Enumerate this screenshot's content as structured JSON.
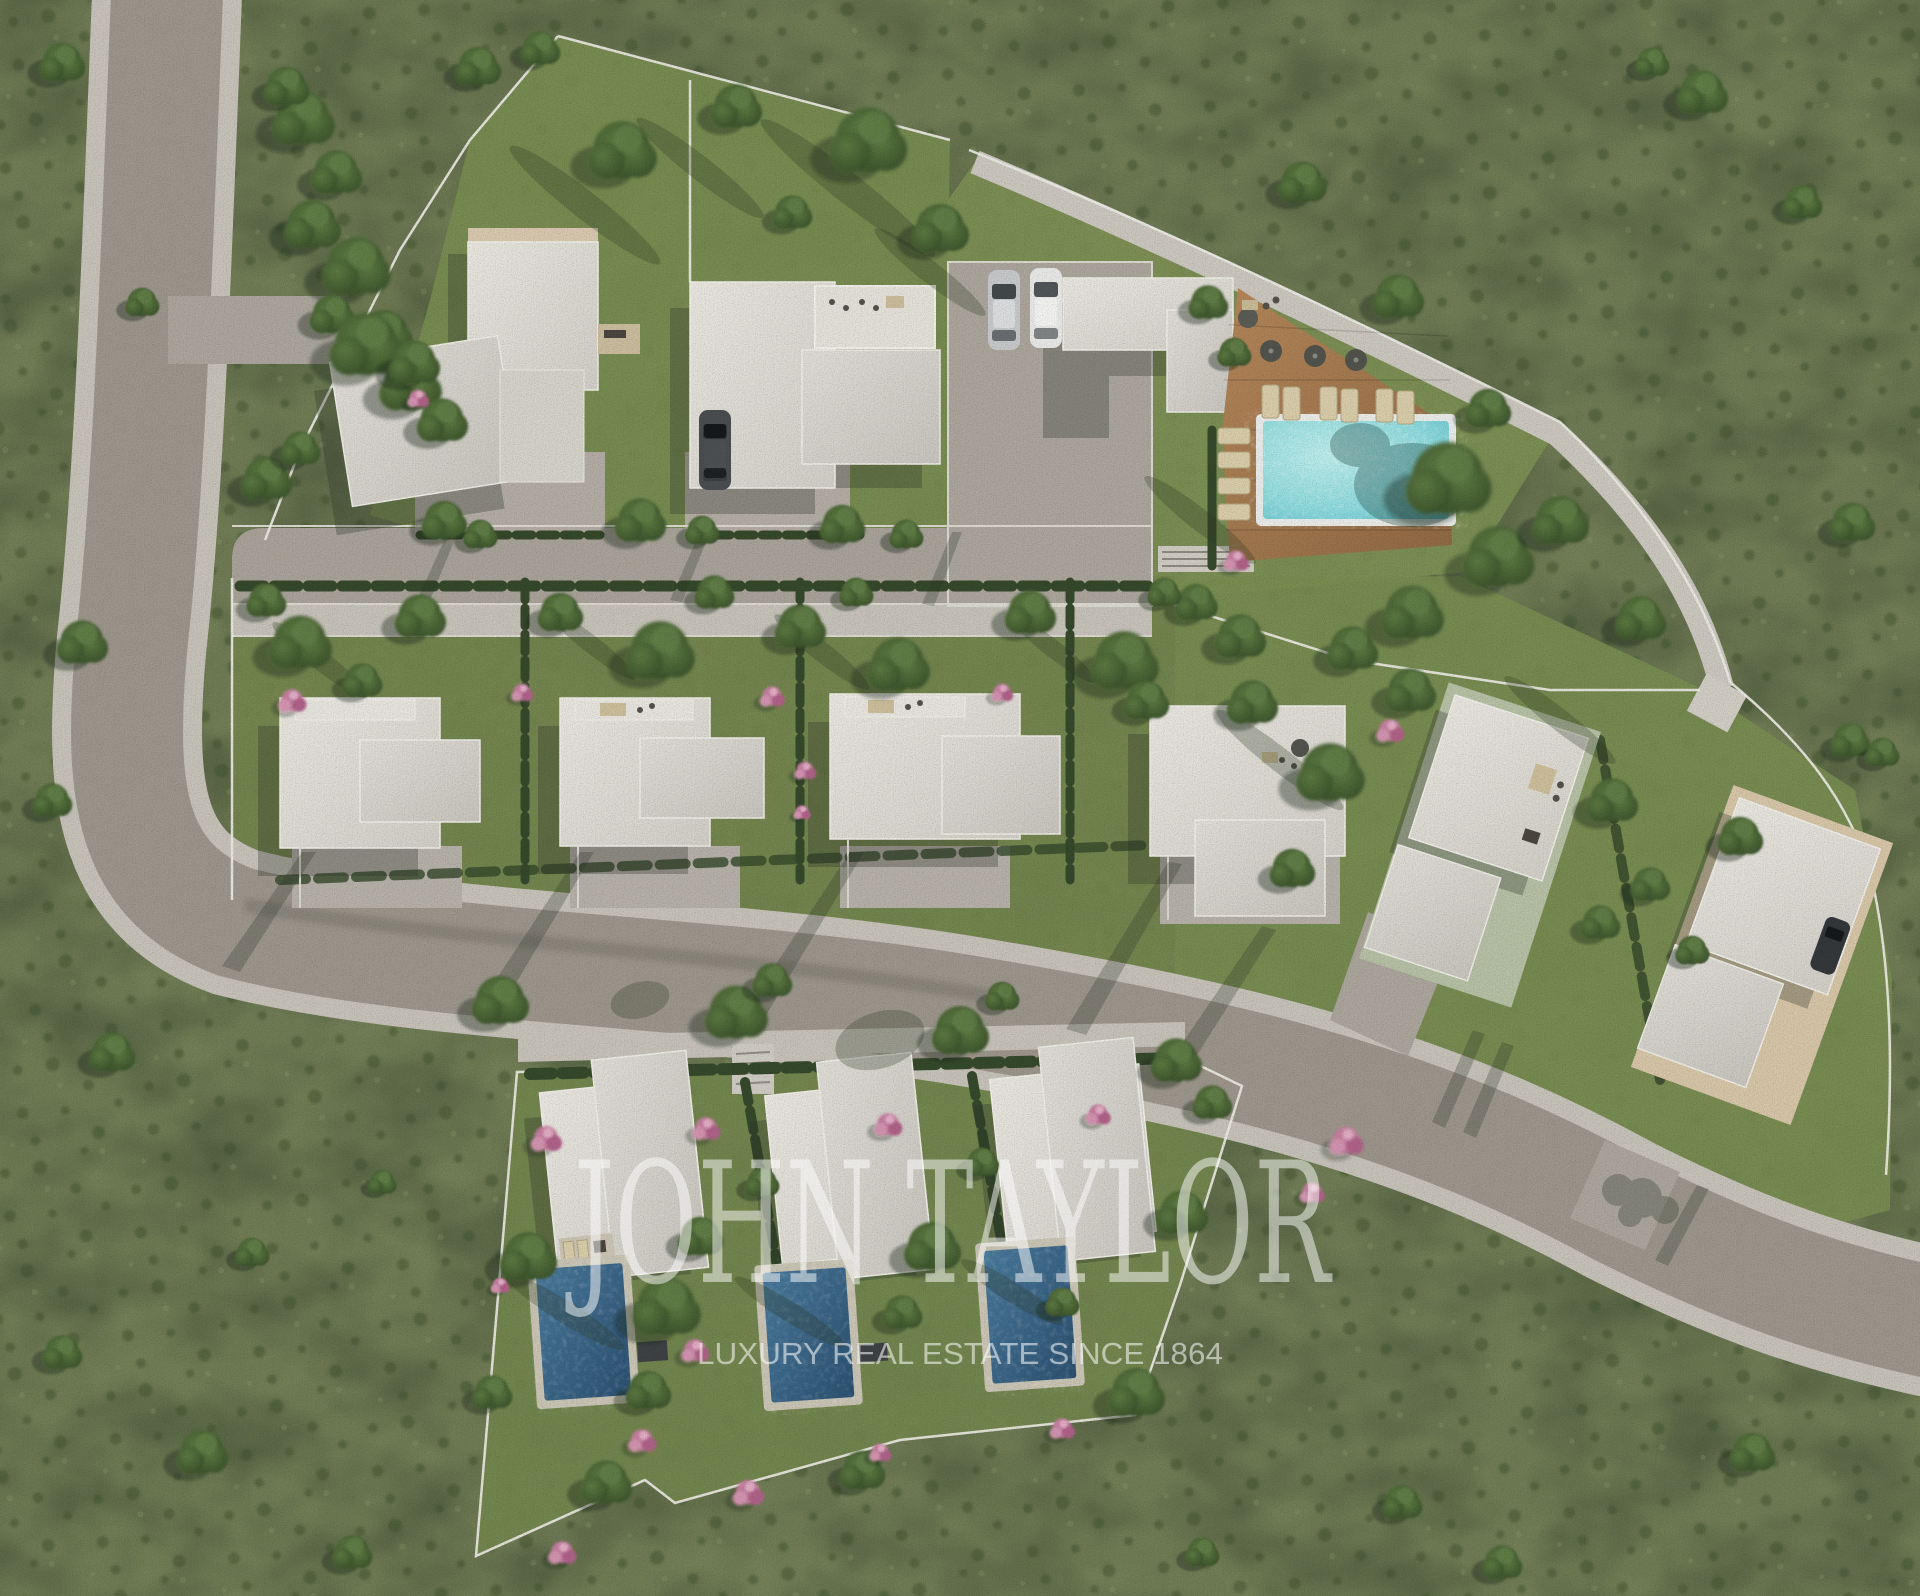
{
  "image": {
    "kind": "aerial-3d-masterplan-render",
    "description": "Top-down 3D rendering of a luxury villa development: two villa clusters with a communal pool and wood deck, a middle row of white flat-roof villas, three villas with private pools below, connected by curved grey roads through green scrubland."
  },
  "watermark": {
    "brand": "JOHN TAYLOR",
    "tagline": "LUXURY REAL ESTATE SINCE 1864"
  },
  "scene": {
    "top_cluster": {
      "villas": 2,
      "parked_cars": 3,
      "communal_pool": 1,
      "sun_loungers": 10,
      "parasols": 3
    },
    "middle_row": {
      "villas": 6
    },
    "bottom_cluster": {
      "villas": 3,
      "private_pools": 3
    },
    "total_villas": 11
  },
  "palette": {
    "scrub_green": "#707c56",
    "lawn_green": "#7a8e52",
    "hedge_green": "#36492b",
    "asphalt_grey": "#9d968c",
    "sidewalk_grey": "#c7c3ba",
    "roof_white": "#e0ddd7",
    "deck_wood_brown": "#ab7d52",
    "communal_pool_turquoise": "#7fd2d6",
    "private_pool_blue": "#335a7d",
    "bougainvillea_pink": "#c57f9e",
    "watermark_white": "#ffffff"
  }
}
